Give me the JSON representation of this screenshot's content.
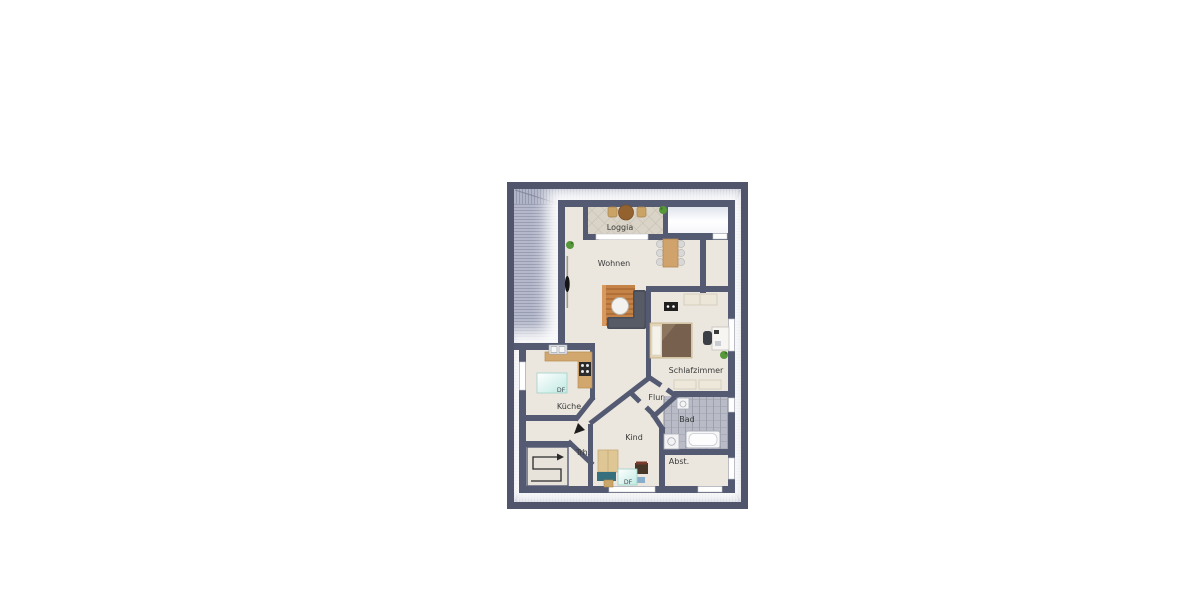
{
  "plan": {
    "type": "attic-floor-plan",
    "rooms": {
      "loggia": "Loggia",
      "wohnen": "Wohnen",
      "schlafzimmer": "Schlafzimmer",
      "kueche": "Küche",
      "flur": "Flur",
      "bad": "Bad",
      "kind": "Kind",
      "trh": "Trh.",
      "abst": "Abst."
    },
    "skylights": {
      "kueche": "DF",
      "kind": "DF"
    },
    "colors": {
      "page_background": "#ffffff",
      "roof_frame": "#50556c",
      "roof_band": "#b4b8ca",
      "roof_stripe": "#989db2",
      "wall": "#545a72",
      "floor": "#ebe7de",
      "loggia_tile": "#d9d4c7",
      "bath_tile": "#b9bcc6",
      "counter_wood": "#d2a76e",
      "rug_wood": "#c08049",
      "sofa_gray": "#4a4e58",
      "skylight_glass": "#bfe9e2",
      "plant_green": "#56983a"
    }
  }
}
